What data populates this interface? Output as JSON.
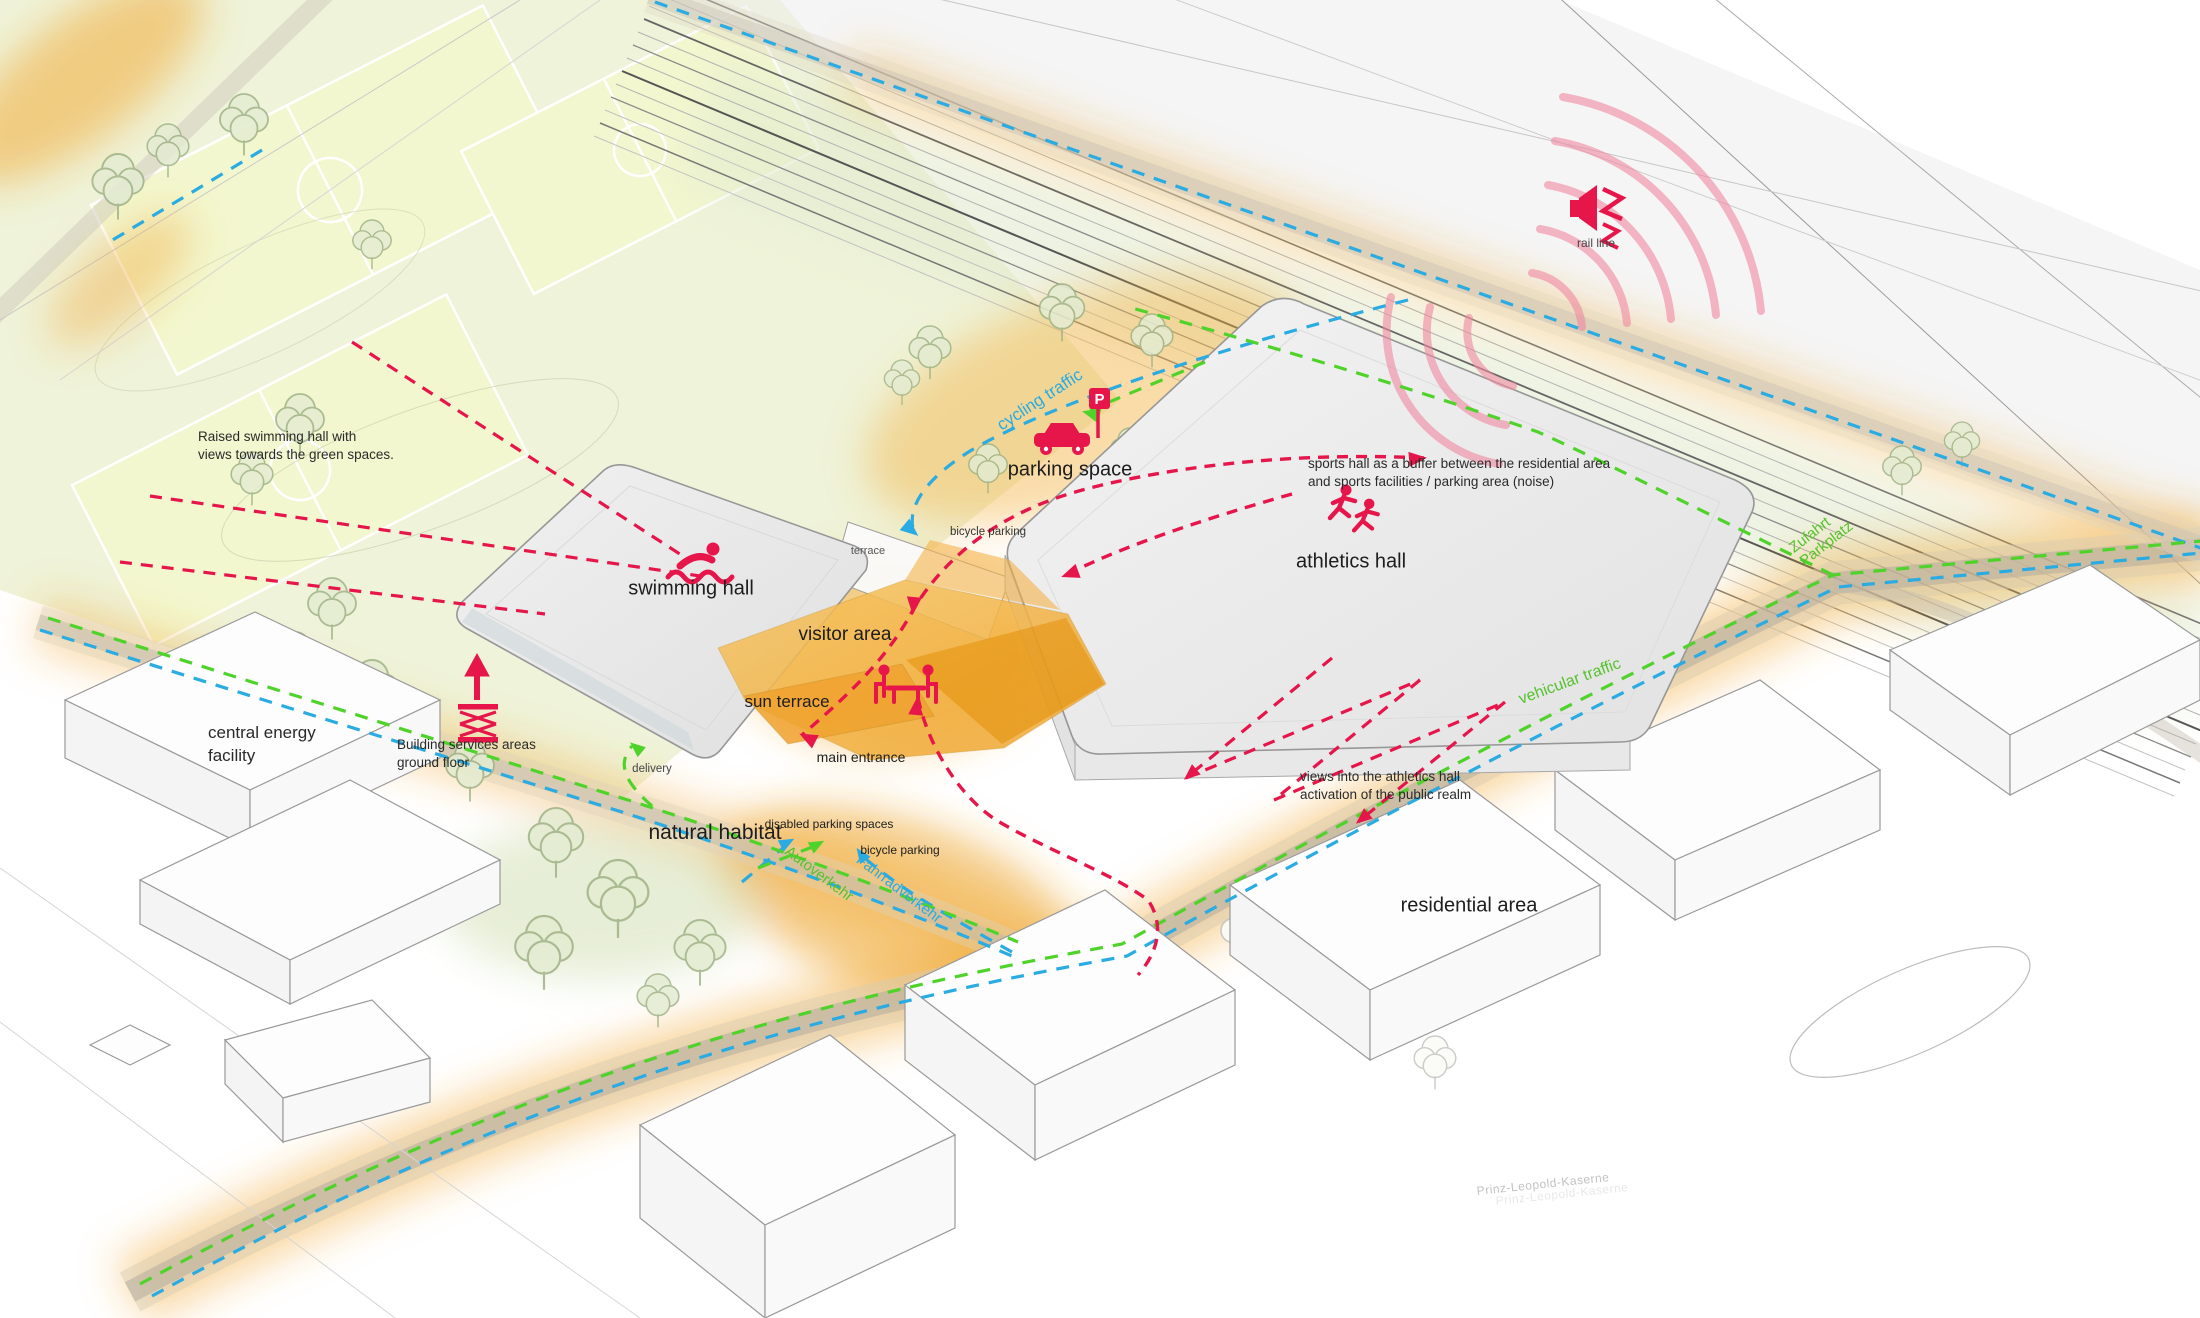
{
  "title": "sports campus site diagram",
  "colors": {
    "accent_pink": "#e6164b",
    "arc_pink": "#f087a0",
    "traffic_blue": "#2aabe2",
    "traffic_green": "#4fd32a",
    "plaza_orange": "#f0a12f",
    "field_green": "#eef2d8",
    "building_grey": "#ececec"
  },
  "labels": {
    "rail_line": "rail line",
    "cycling_traffic": "cycling traffic",
    "parking_space": "parking space",
    "parking_p": "P",
    "athletics_hall": "athletics hall",
    "swimming_hall": "swimming hall",
    "terrace": "terrace",
    "bicycle_parking_top": "bicycle parking",
    "visitor_area": "visitor area",
    "sun_terrace": "sun terrace",
    "main_entrance": "main entrance",
    "central_energy_line1": "central energy",
    "central_energy_line2": "facility",
    "delivery": "delivery",
    "natural_habitat": "natural habitat",
    "disabled_parking": "disabled parking spaces",
    "bicycle_parking_bottom": "bicycle parking",
    "autoverkehr": "Autoverkehr",
    "fahrradverkehr": "Fahrradverkehr",
    "vehicular_traffic": "vehicular traffic",
    "zufahrt_line1": "Zufahrt",
    "zufahrt_line2": "Parkplatz",
    "residential_area": "residential area",
    "prinz_leopold": "Prinz-Leopold-Kaserne"
  },
  "notes": {
    "raised_swimming_line1": "Raised swimming hall with",
    "raised_swimming_line2": "views towards the green spaces.",
    "buffer_line1": "sports hall as a buffer between the residential area",
    "buffer_line2": "and sports facilities / parking area (noise)",
    "building_services_line1": "Building services areas",
    "building_services_line2": "ground floor",
    "views_line1": "views into the athletics hall",
    "views_line2": "activation of the public realm"
  },
  "icons": [
    "noise-speaker-icon",
    "swimmer-icon",
    "runners-icon",
    "car-parking-icon",
    "picnic-table-icon",
    "scissor-lift-icon"
  ]
}
